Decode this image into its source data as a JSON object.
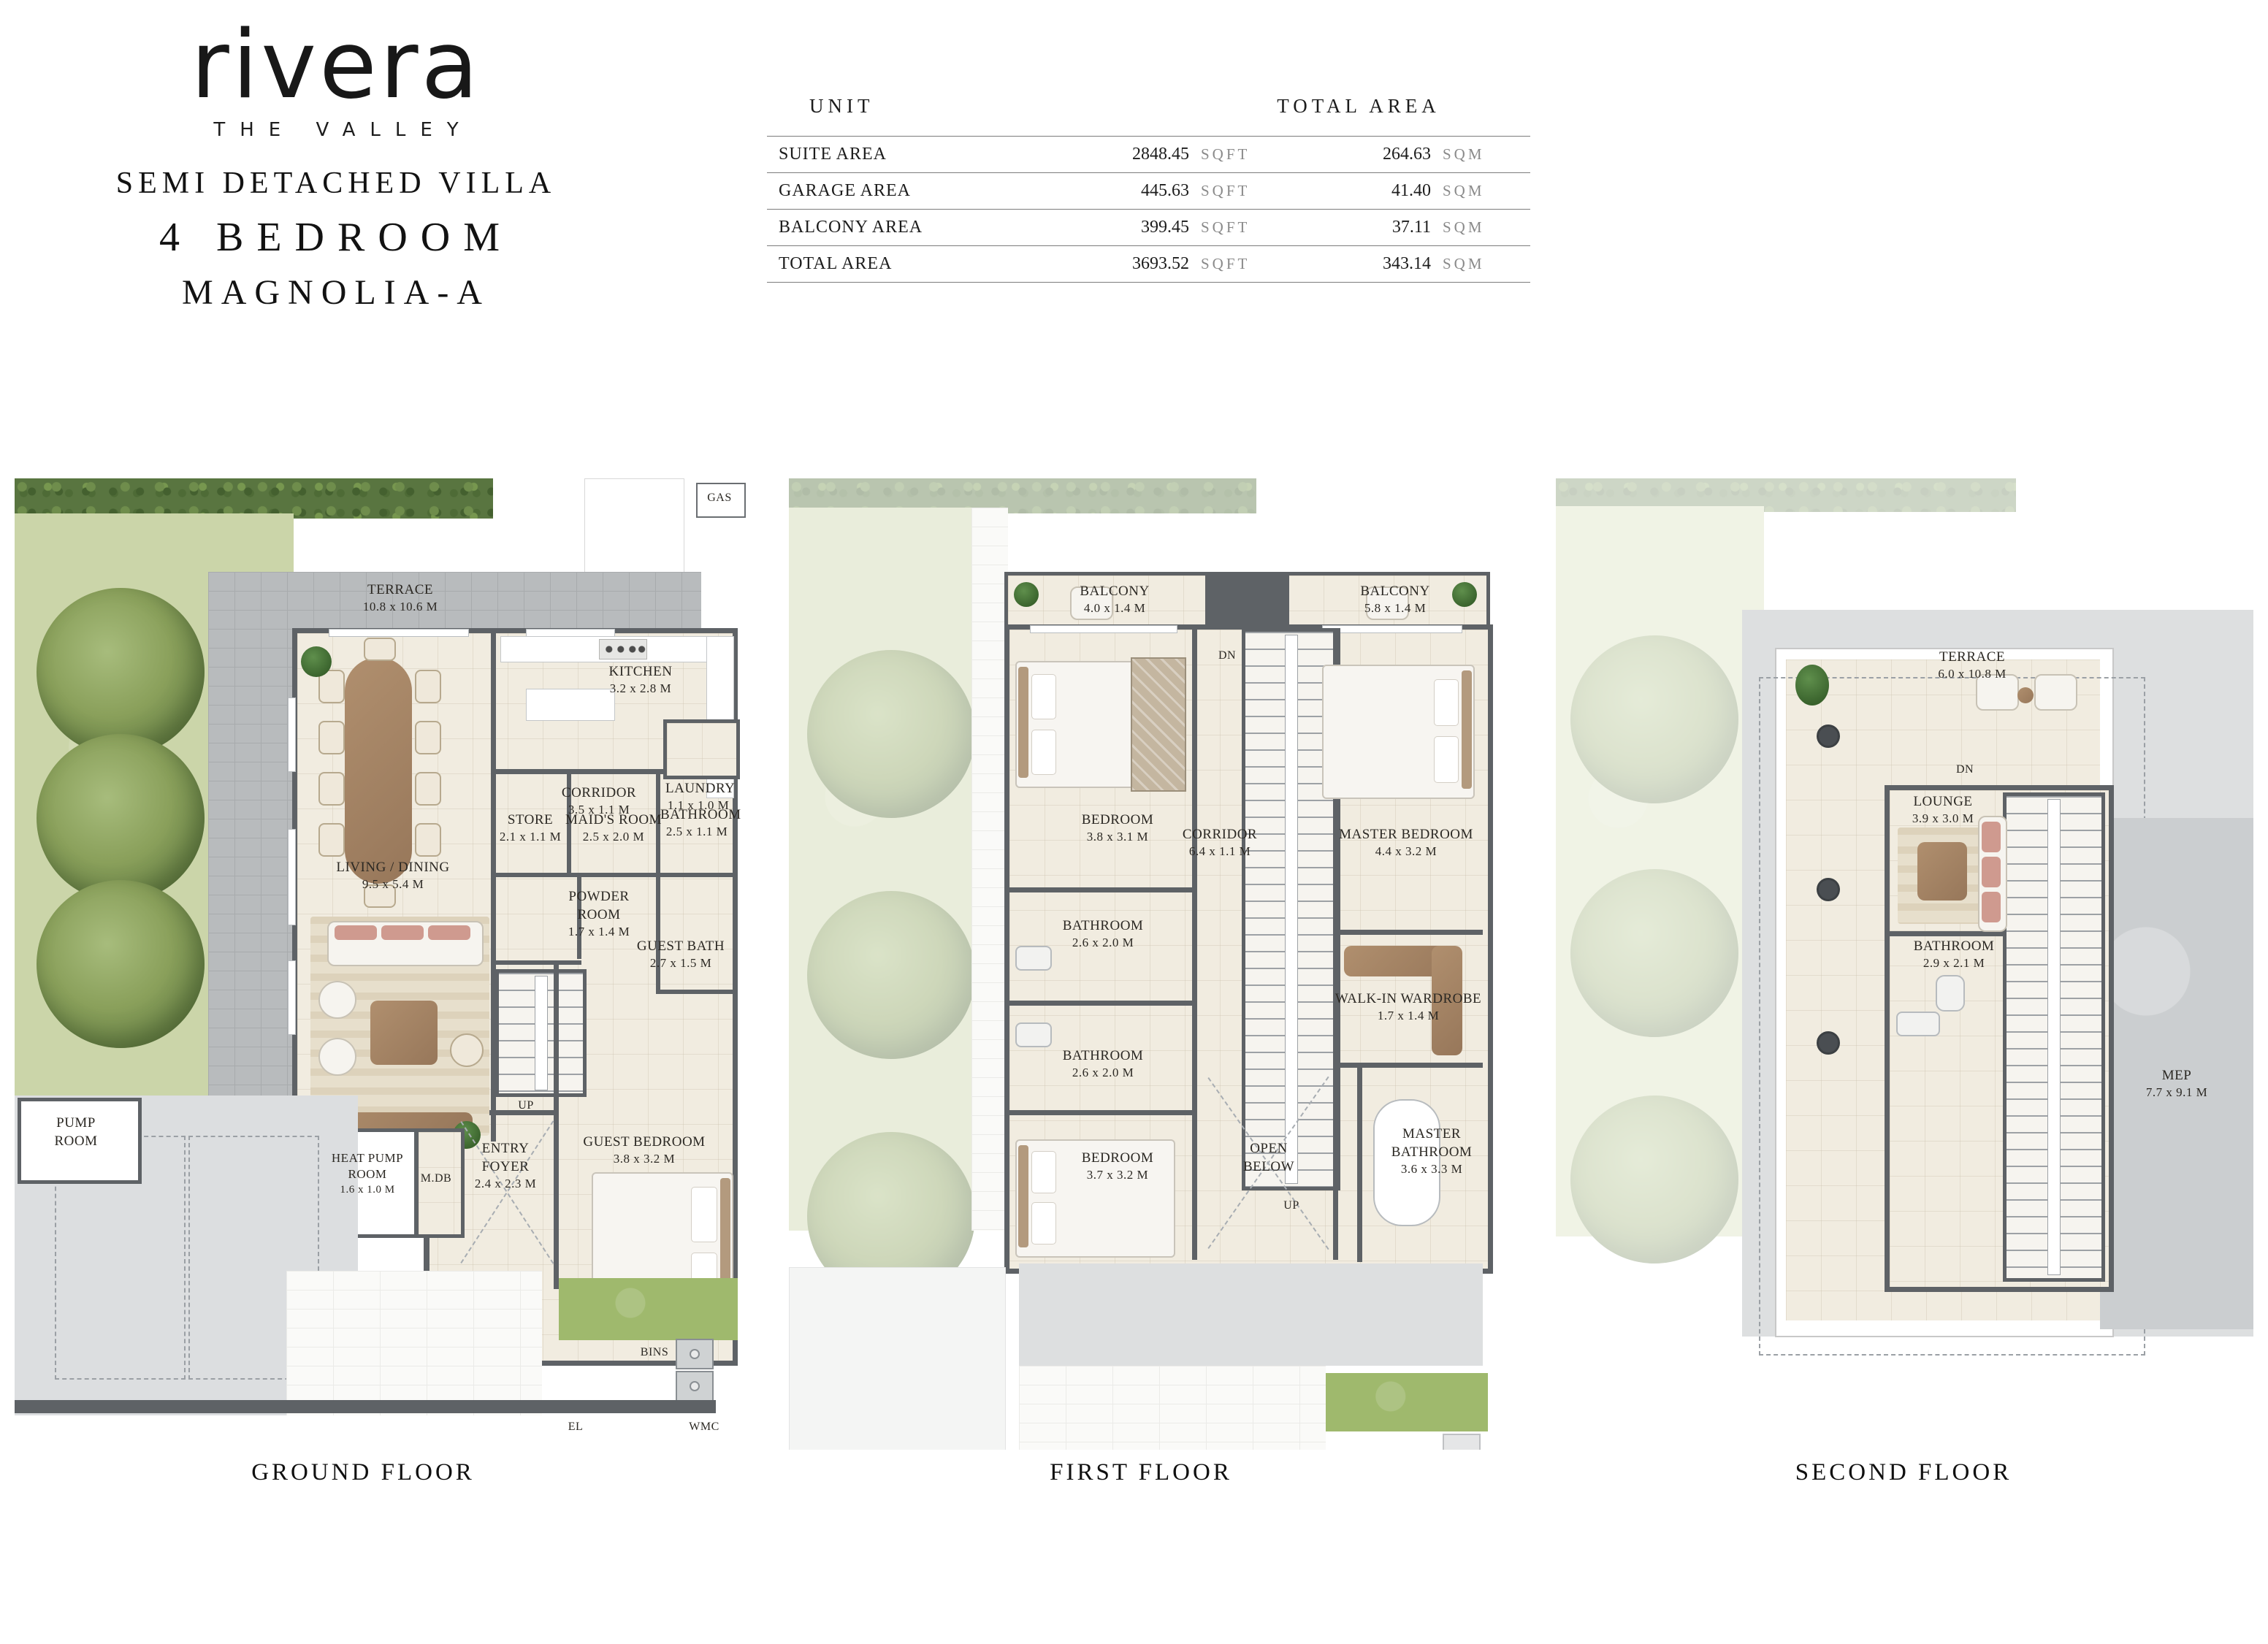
{
  "brand": {
    "logo": "rivera",
    "tagline": "THE VALLEY",
    "line1": "SEMI DETACHED VILLA",
    "line2": "4 BEDROOM",
    "line3": "MAGNOLIA-A"
  },
  "area_table": {
    "col_unit": "UNIT",
    "col_total": "TOTAL AREA",
    "rows": [
      {
        "label": "SUITE AREA",
        "sqft": "2848.45",
        "sqft_unit": "SQFT",
        "sqm": "264.63",
        "sqm_unit": "SQM"
      },
      {
        "label": "GARAGE AREA",
        "sqft": "445.63",
        "sqft_unit": "SQFT",
        "sqm": "41.40",
        "sqm_unit": "SQM"
      },
      {
        "label": "BALCONY AREA",
        "sqft": "399.45",
        "sqft_unit": "SQFT",
        "sqm": "37.11",
        "sqm_unit": "SQM"
      },
      {
        "label": "TOTAL AREA",
        "sqft": "3693.52",
        "sqft_unit": "SQFT",
        "sqm": "343.14",
        "sqm_unit": "SQM"
      }
    ]
  },
  "floors": {
    "ground": {
      "caption": "GROUND FLOOR",
      "labels": {
        "gas": "GAS",
        "terrace": {
          "name": "TERRACE",
          "dims": "10.8 x 10.6 M"
        },
        "kitchen": {
          "name": "KITCHEN",
          "dims": "3.2 x 2.8 M"
        },
        "corridor": {
          "name": "CORRIDOR",
          "dims": "3.5 x 1.1 M"
        },
        "laundry": {
          "name": "LAUNDRY",
          "dims": "1.1 x 1.0 M"
        },
        "living": {
          "name": "LIVING / DINING",
          "dims": "9.5 x 5.4 M"
        },
        "store": {
          "name": "STORE",
          "dims": "2.1 x 1.1 M"
        },
        "maids": {
          "name": "MAID'S ROOM",
          "dims": "2.5 x 2.0 M"
        },
        "bathroom": {
          "name": "BATHROOM",
          "dims": "2.5 x 1.1 M"
        },
        "powder": {
          "name": "POWDER ROOM",
          "dims": "1.7 x 1.4 M"
        },
        "guest_bath": {
          "name": "GUEST BATH",
          "dims": "2.7 x 1.5 M"
        },
        "pump": {
          "name": "PUMP ROOM"
        },
        "heat_pump": {
          "name": "HEAT PUMP ROOM",
          "dims": "1.6 x 1.0 M"
        },
        "mdb": "M.DB",
        "entry": {
          "name": "ENTRY FOYER",
          "dims": "2.4 x 2.3 M"
        },
        "guest_bed": {
          "name": "GUEST BEDROOM",
          "dims": "3.8 x 3.2 M"
        },
        "up": "UP",
        "bins": "BINS",
        "el": "EL",
        "wmc": "WMC"
      }
    },
    "first": {
      "caption": "FIRST FLOOR",
      "labels": {
        "balcony_a": {
          "name": "BALCONY",
          "dims": "4.0 x 1.4 M"
        },
        "balcony_b": {
          "name": "BALCONY",
          "dims": "5.8 x 1.4 M"
        },
        "dn": "DN",
        "bedroom_a": {
          "name": "BEDROOM",
          "dims": "3.8 x 3.1 M"
        },
        "master_bedroom": {
          "name": "MASTER BEDROOM",
          "dims": "4.4 x 3.2 M"
        },
        "corridor": {
          "name": "CORRIDOR",
          "dims": "6.4 x 1.1 M"
        },
        "bathroom_a": {
          "name": "BATHROOM",
          "dims": "2.6 x 2.0 M"
        },
        "bathroom_b": {
          "name": "BATHROOM",
          "dims": "2.6 x 2.0 M"
        },
        "wardrobe": {
          "name": "WALK-IN WARDROBE",
          "dims": "1.7 x 1.4 M"
        },
        "up": "UP",
        "open_below": {
          "name": "OPEN BELOW"
        },
        "master_bath": {
          "name": "MASTER BATHROOM",
          "dims": "3.6 x 3.3 M"
        },
        "bedroom_b": {
          "name": "BEDROOM",
          "dims": "3.7 x 3.2 M"
        }
      }
    },
    "second": {
      "caption": "SECOND FLOOR",
      "labels": {
        "terrace": {
          "name": "TERRACE",
          "dims": "6.0 x 10.8 M"
        },
        "dn": "DN",
        "lounge": {
          "name": "LOUNGE",
          "dims": "3.9 x 3.0 M"
        },
        "bathroom": {
          "name": "BATHROOM",
          "dims": "2.9 x 2.1 M"
        },
        "mep": {
          "name": "MEP",
          "dims": "7.7 x 9.1 M"
        }
      }
    }
  }
}
